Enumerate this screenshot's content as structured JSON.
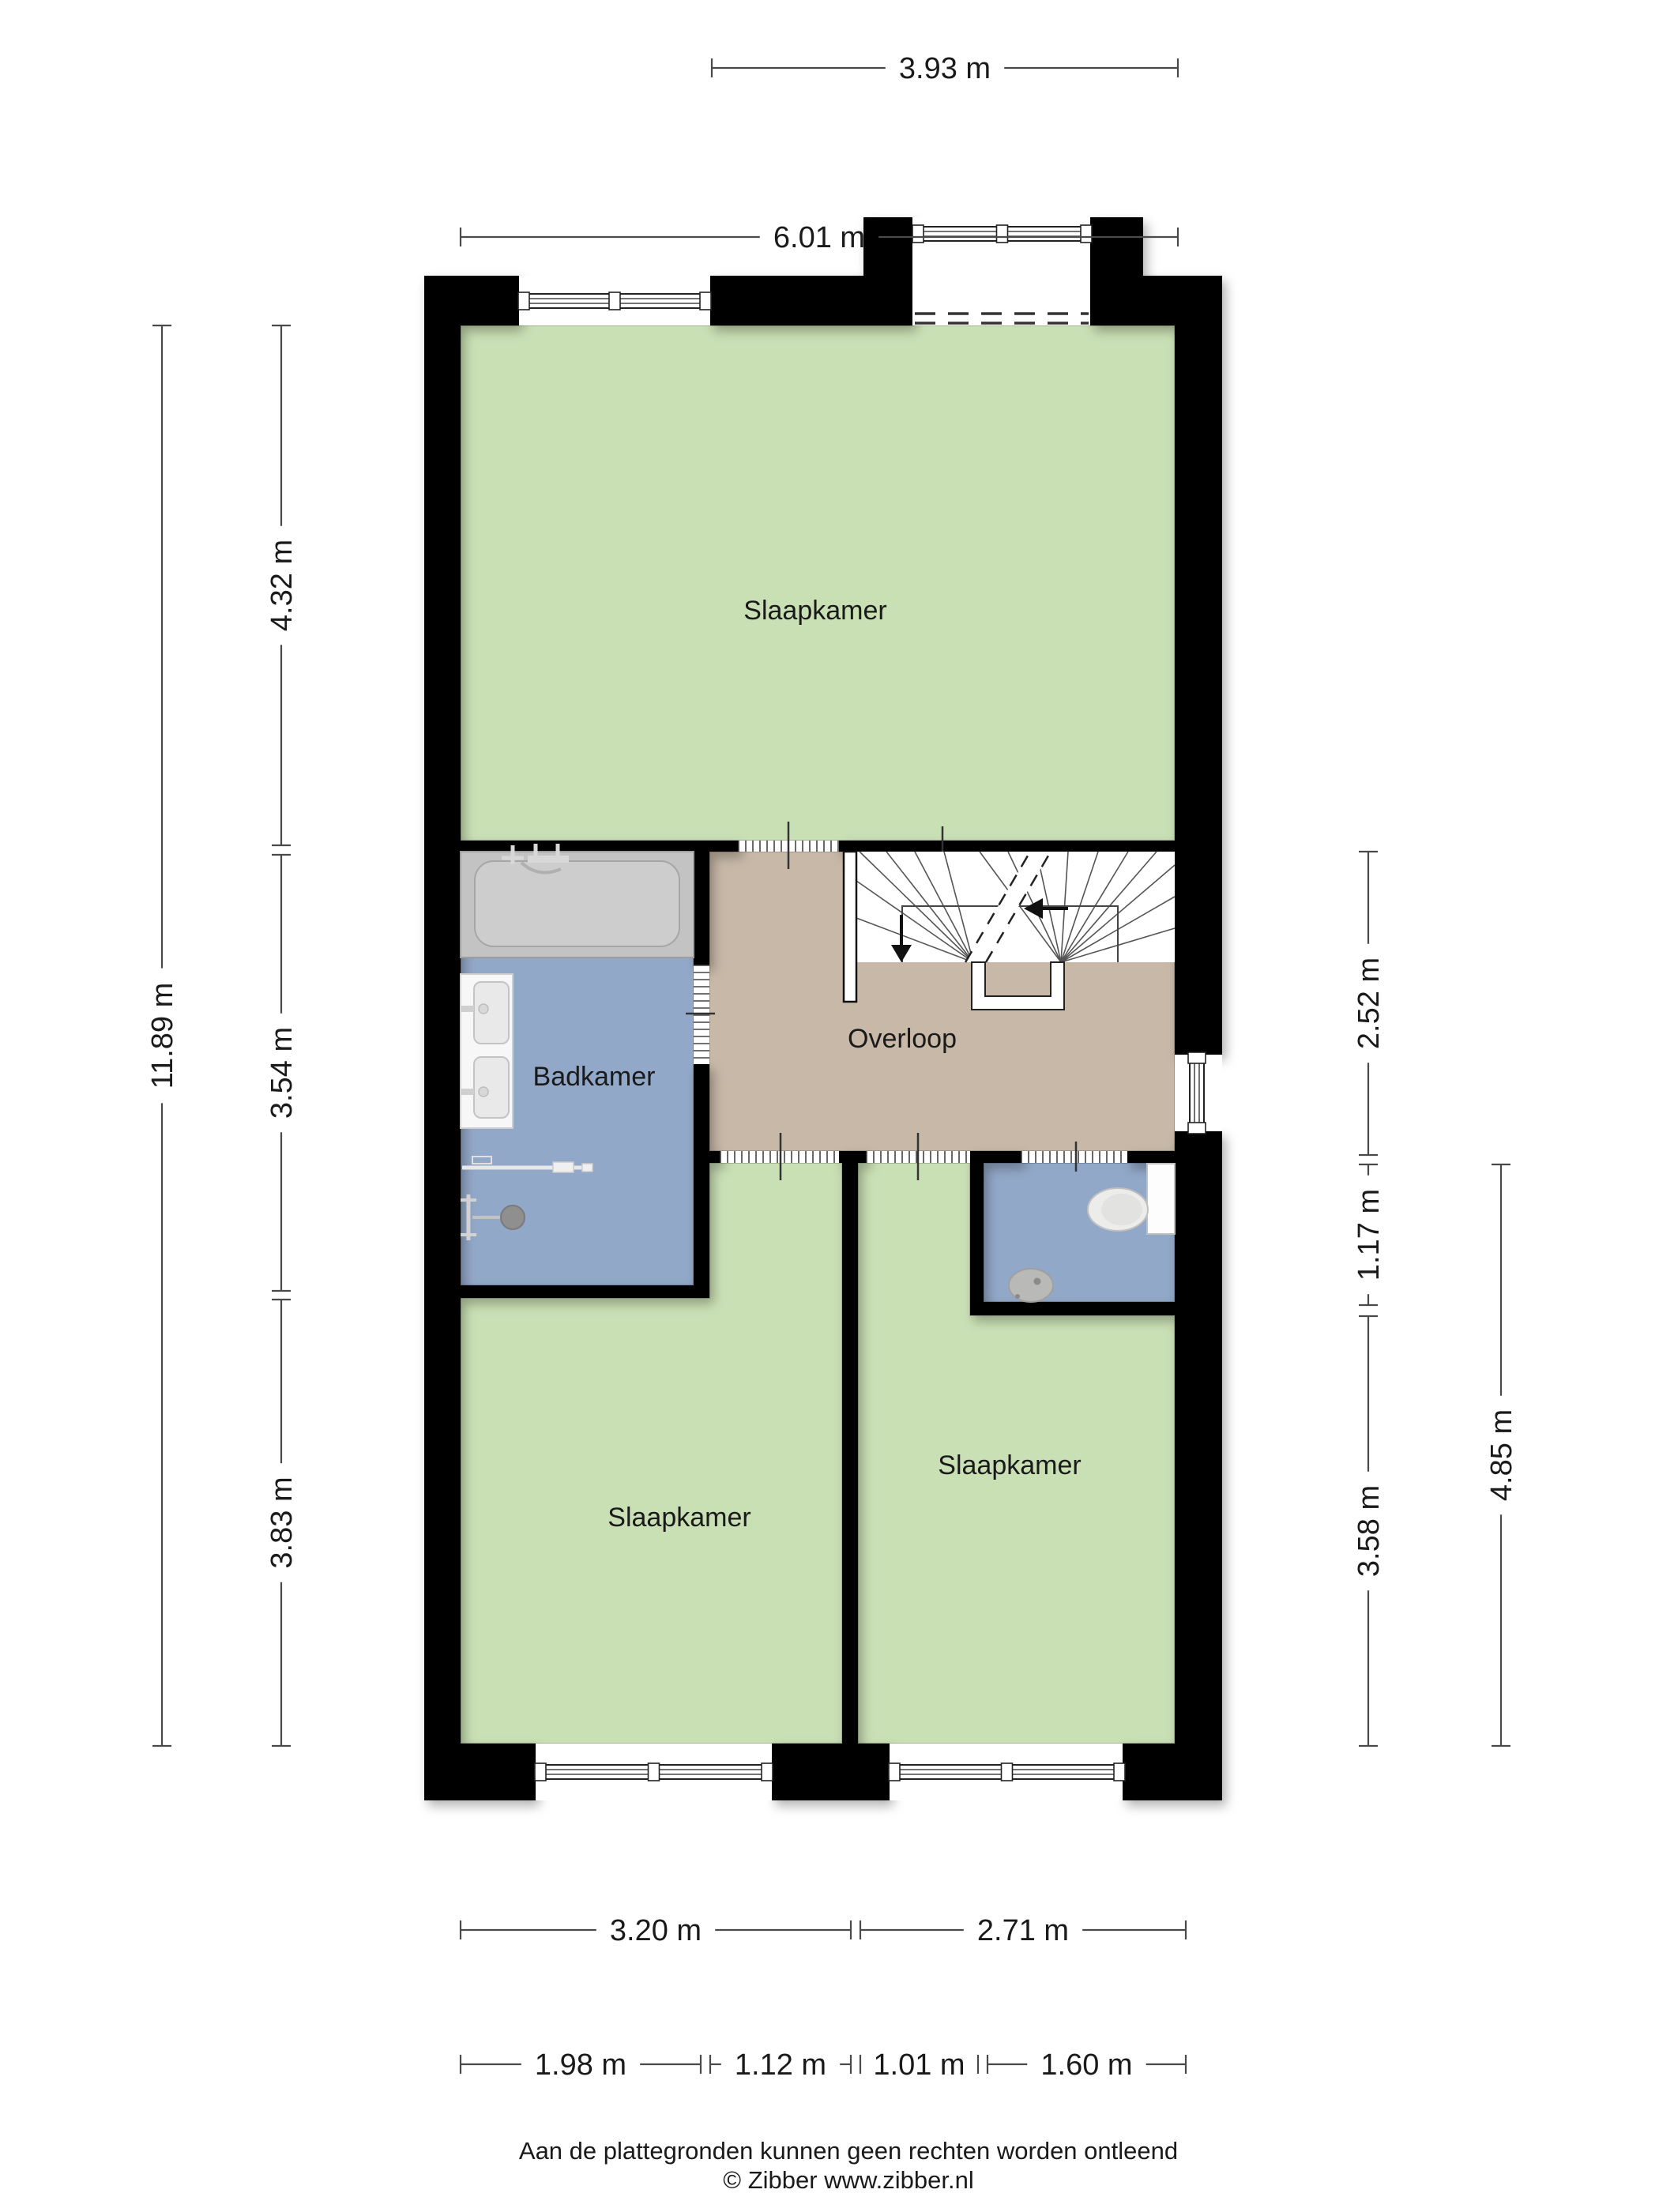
{
  "title": "Floor plan - verdieping (Zibber plattegrond)",
  "rooms": {
    "top": "Slaapkamer",
    "badkamer": "Badkamer",
    "overloop": "Overloop",
    "bottom_left": "Slaapkamer",
    "bottom_right": "Slaapkamer"
  },
  "dimensions": {
    "top_inner": "3.93 m",
    "top_outer": "6.01 m",
    "left_total": "11.89 m",
    "left_top": "4.32 m",
    "left_mid": "3.54 m",
    "left_bottom": "3.83 m",
    "right_overloop": "2.52 m",
    "right_toilet": "1.17 m",
    "right_bedroom": "3.58 m",
    "right_total": "4.85 m",
    "bottom_left_room": "3.20 m",
    "bottom_right_room": "2.71 m",
    "bottom_d1": "1.98 m",
    "bottom_d2": "1.12 m",
    "bottom_d3": "1.01 m",
    "bottom_d4": "1.60 m"
  },
  "footer": {
    "disclaimer": "Aan de plattegronden kunnen geen rechten worden ontleend",
    "credit": "© Zibber www.zibber.nl"
  },
  "colors": {
    "wall": "#000000",
    "room_green": "#c9dfb4",
    "room_blue": "#92a8c8",
    "room_tan": "#c7b8a7",
    "room_edge": "rgba(0,0,0,0.18)",
    "dim_line": "#4a4a4a",
    "text": "#1a1a1a",
    "fixture_gray": "#c3c3c3",
    "fixture_light": "#cdcdcd",
    "white": "#ffffff"
  }
}
